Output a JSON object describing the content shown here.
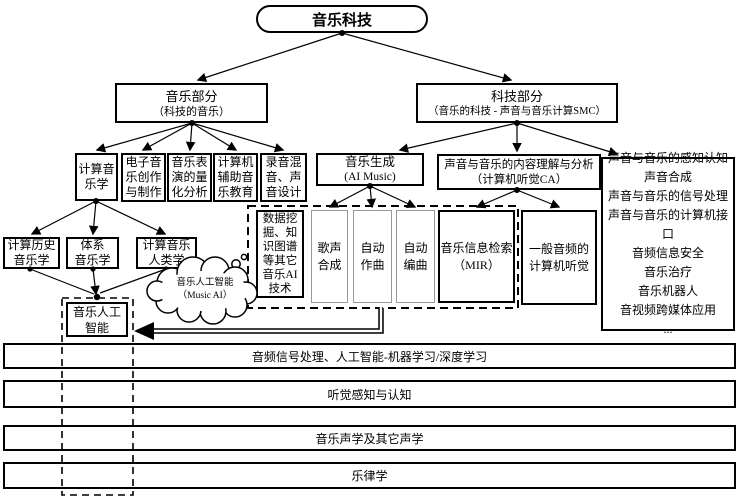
{
  "root": {
    "label": "音乐科技"
  },
  "music_part": {
    "title": "音乐部分",
    "subtitle": "（科技的音乐）"
  },
  "tech_part": {
    "title": "科技部分",
    "subtitle": "（音乐的科技 - 声音与音乐计算SMC）"
  },
  "music_fields": [
    {
      "label": "计算音\n乐学"
    },
    {
      "label": "电子音\n乐创作\n与制作"
    },
    {
      "label": "音乐表\n演的量\n化分析"
    },
    {
      "label": "计算机\n辅助音\n乐教育"
    },
    {
      "label": "录音混\n音、声\n音设计"
    }
  ],
  "musicology_children": [
    {
      "label": "计算历史\n音乐学"
    },
    {
      "label": "体系\n音乐学"
    },
    {
      "label": "计算音乐\n人类学"
    }
  ],
  "music_generation": {
    "title": "音乐生成",
    "subtitle": "(AI Music)"
  },
  "content_analysis": {
    "title": "声音与音乐的内容理解与分析",
    "subtitle": "（计算机听觉CA）"
  },
  "ai_group": {
    "data_mining": {
      "label": "数据挖\n掘、知\n识图谱\n等其它\n音乐AI\n技术"
    },
    "singing_synthesis": {
      "label": "歌声\n合成"
    },
    "auto_composition": {
      "label": "自动\n作曲"
    },
    "auto_arrangement": {
      "label": "自动\n编曲"
    },
    "mir": {
      "label": "音乐信息检索\n（MIR）"
    }
  },
  "general_audio": {
    "label": "一般音频的\n计算机听觉"
  },
  "tech_list": {
    "items": [
      "声音与音乐的感知认知",
      "声音合成",
      "声音与音乐的信号处理",
      "声音与音乐的计算机接口",
      "音频信息安全",
      "音乐治疗",
      "音乐机器人",
      "音视频跨媒体应用",
      "..."
    ]
  },
  "music_ai": {
    "label": "音乐人工\n智能"
  },
  "cloud": {
    "label": "音乐人工智能\n（Music AI）"
  },
  "foundation_bars": [
    {
      "label": "音频信号处理、人工智能-机器学习/深度学习"
    },
    {
      "label": "听觉感知与认知"
    },
    {
      "label": "音乐声学及其它声学"
    },
    {
      "label": "乐律学"
    }
  ],
  "colors": {
    "line": "#000000",
    "gray_border": "#999999",
    "background": "#ffffff"
  }
}
